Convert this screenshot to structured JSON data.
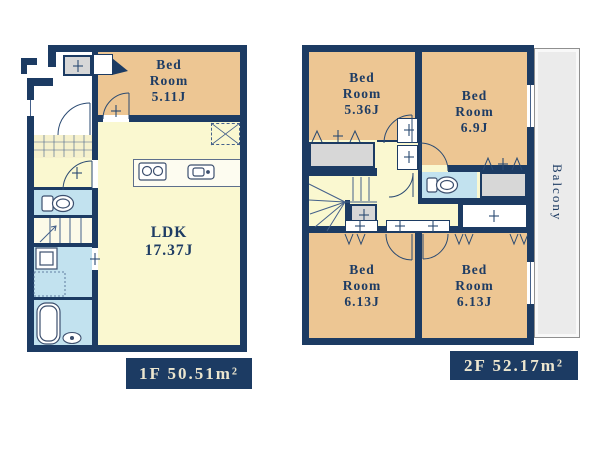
{
  "floor1": {
    "area_label": "1F 50.51m²",
    "bedroom": "Bed\nRoom\n5.11J",
    "ldk": "LDK\n17.37J"
  },
  "floor2": {
    "area_label": "2F 52.17m²",
    "bedroom_top_left": "Bed\nRoom\n5.36J",
    "bedroom_top_right": "Bed\nRoom\n6.9J",
    "bedroom_bottom_left": "Bed\nRoom\n6.13J",
    "bedroom_bottom_right": "Bed\nRoom\n6.13J",
    "balcony": "Balcony"
  },
  "colors": {
    "wall_navy": "#1c3b63",
    "room_orange": "#edc693",
    "floor_yellow": "#faf8d0",
    "wet_area_blue": "#c2e2ef",
    "closet_gray": "#d7d7d7",
    "balcony_gray": "#ebebeb",
    "label_text_cream": "#ece6cf"
  }
}
